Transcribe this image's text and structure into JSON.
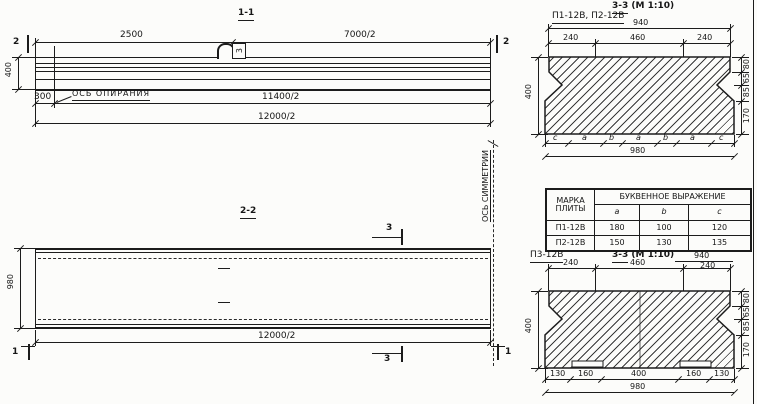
{
  "s11": {
    "title": "1-1",
    "cut_mark": "2",
    "dim_2500": "2500",
    "dim_7000": "7000/2",
    "dim_300": "300",
    "dim_11400": "11400/2",
    "dim_12000": "12000/2",
    "dim_400": "400",
    "support_axis_label": "ОСЬ ОПИРАНИЯ",
    "loop_tag": "3"
  },
  "s22": {
    "title": "2-2",
    "cut_mark_3": "3",
    "cut_mark_1": "1",
    "dim_980": "980",
    "dim_12000": "12000/2",
    "symmetry_axis_label": "ОСЬ СИММЕТРИИ"
  },
  "s33a": {
    "label": "П1-12В, П2-12В",
    "title_num": "3-3",
    "title_scale": "(М 1:10)",
    "dim_940": "940",
    "dims_top": [
      "240",
      "460",
      "240"
    ],
    "dim_left": "400",
    "dims_right": [
      "80",
      "65",
      "85",
      "170"
    ],
    "letters": [
      "c",
      "a",
      "b",
      "a",
      "b",
      "a",
      "c"
    ],
    "dim_980": "980"
  },
  "table": {
    "header_mark": "МАРКА ПЛИТЫ",
    "header_group": "БУКВЕННОЕ ВЫРАЖЕНИЕ",
    "cols": [
      "a",
      "b",
      "c"
    ],
    "rows": [
      [
        "П1-12В",
        "180",
        "100",
        "120"
      ],
      [
        "П2-12В",
        "150",
        "130",
        "135"
      ]
    ]
  },
  "s33b": {
    "label": "П3-12В",
    "title_num": "3-3",
    "title_scale": "(М 1:10)",
    "dim_940": "940",
    "dims_top": [
      "240",
      "460",
      "240"
    ],
    "dim_left": "400",
    "dims_right": [
      "80",
      "65",
      "85",
      "170"
    ],
    "dims_bottom": [
      "130",
      "160",
      "400",
      "160",
      "130"
    ],
    "dim_980": "980"
  }
}
